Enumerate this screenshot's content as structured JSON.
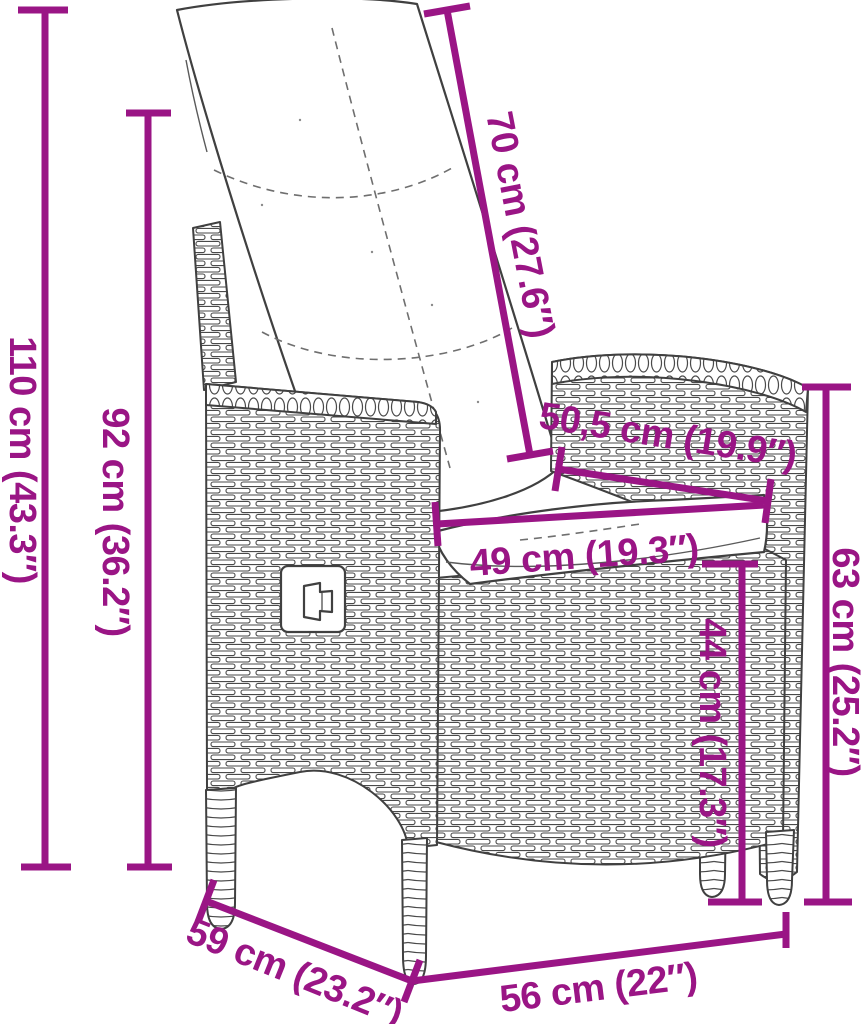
{
  "colors": {
    "dimension_accent": "#9a1585",
    "line_art": "#404040",
    "background": "#ffffff"
  },
  "dimensions": {
    "overall_height": {
      "label": "110 cm (43.3″)"
    },
    "back_height": {
      "label": "92 cm (36.2″)"
    },
    "cushion_length": {
      "label": "70 cm (27.6″)"
    },
    "armrest_length": {
      "label": "50,5 cm (19.9″)"
    },
    "seat_width": {
      "label": "49 cm (19.3″)"
    },
    "armrest_height": {
      "label": "63 cm (25.2″)"
    },
    "seat_height": {
      "label": "44 cm (17.3″)"
    },
    "depth": {
      "label": "59 cm (23.2″)"
    },
    "width": {
      "label": "56 cm (22″)"
    }
  }
}
